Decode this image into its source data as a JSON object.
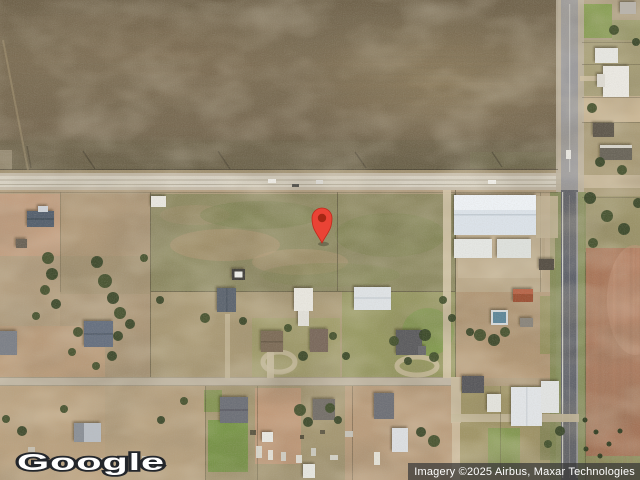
{
  "map": {
    "logo_text": "Google",
    "attribution": "Imagery ©2025 Airbus, Maxar Technologies",
    "marker": {
      "transform": "translate(322,243)",
      "color": "#EA4335",
      "inner_color": "#A52714",
      "outline_color": "#C0291C"
    },
    "colors": {
      "plowed_field": "#776851",
      "dirt_ground": "#b29d7f",
      "pasture": "#8b8a60",
      "red_field": "#b07f63",
      "asphalt_road": "#5f626b",
      "dirt_road": "#d8d2c4",
      "attribution_bg": "rgba(56,56,56,0.72)"
    }
  }
}
